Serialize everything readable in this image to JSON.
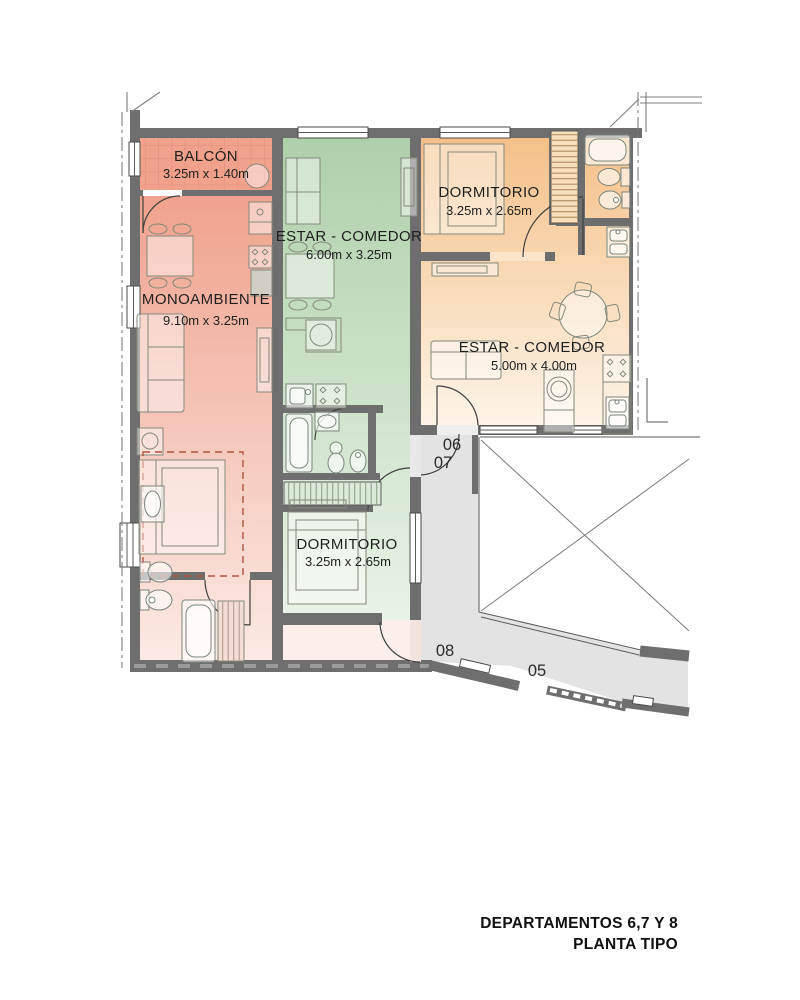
{
  "title": {
    "line1": "DEPARTAMENTOS 6,7 Y 8",
    "line2": "PLANTA TIPO"
  },
  "rooms": {
    "balcon": {
      "name": "BALCÓN",
      "dims": "3.25m x 1.40m"
    },
    "monoambiente": {
      "name": "MONOAMBIENTE",
      "dims": "9.10m x 3.25m"
    },
    "estar_green": {
      "name": "ESTAR - COMEDOR",
      "dims": "6.00m x 3.25m"
    },
    "dorm_green": {
      "name": "DORMITORIO",
      "dims": "3.25m x 2.65m"
    },
    "dorm_orange": {
      "name": "DORMITORIO",
      "dims": "3.25m x 2.65m"
    },
    "estar_orange": {
      "name": "ESTAR - COMEDOR",
      "dims": "5.00m x 4.00m"
    }
  },
  "units": {
    "u05": "05",
    "u06": "06",
    "u07": "07",
    "u08": "08"
  },
  "colors": {
    "wall": "#6e6e6e",
    "corridor": "#e3e3e3",
    "balcony": "#f1a28c",
    "apartment_pink": "#efa28d",
    "apartment_green": "#aed0a9",
    "apartment_orange": "#f4c088"
  }
}
